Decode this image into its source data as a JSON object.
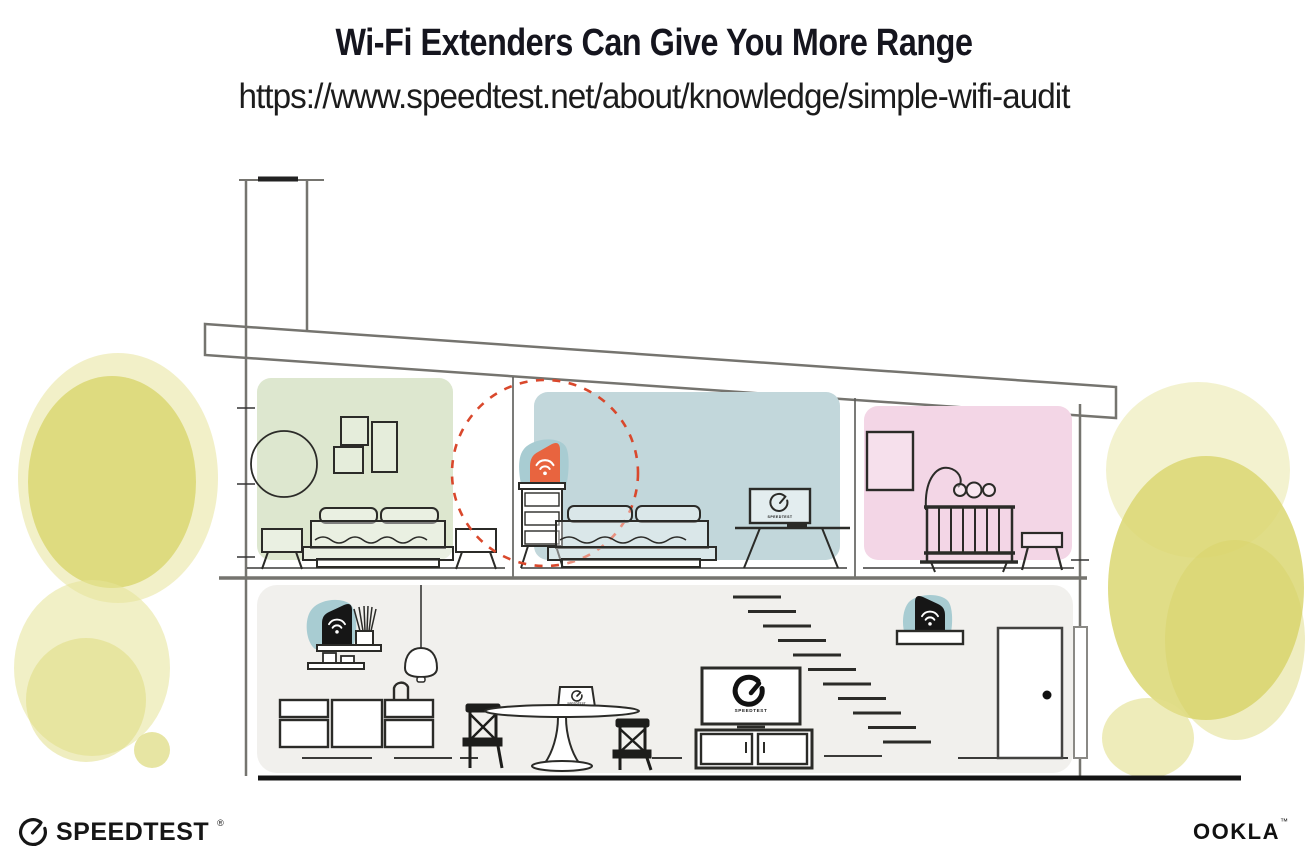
{
  "header": {
    "title": "Wi-Fi Extenders Can Give You More Range",
    "url": "https://www.speedtest.net/about/knowledge/simple-wifi-audit"
  },
  "labels": {
    "device_brand": "SPEEDTEST"
  },
  "footer": {
    "speedtest_wordmark": "SPEEDTEST",
    "speedtest_mark": "®",
    "ookla_wordmark": "OOKLA",
    "ookla_mark": "™"
  },
  "colors": {
    "title_text": "#15151E",
    "green_room": "#DDE7CF",
    "blue_room": "#C2D7DB",
    "pink_room": "#F3D6E6",
    "gray_room": "#F1F0ED",
    "bush_yellow": "#DBD772",
    "extender_orange": "#E8643F",
    "extender_teal": "#A8CCD2",
    "dashed_circle_red": "#D9482C",
    "wall_gray": "#75746F",
    "line_black": "#2B2B28"
  }
}
